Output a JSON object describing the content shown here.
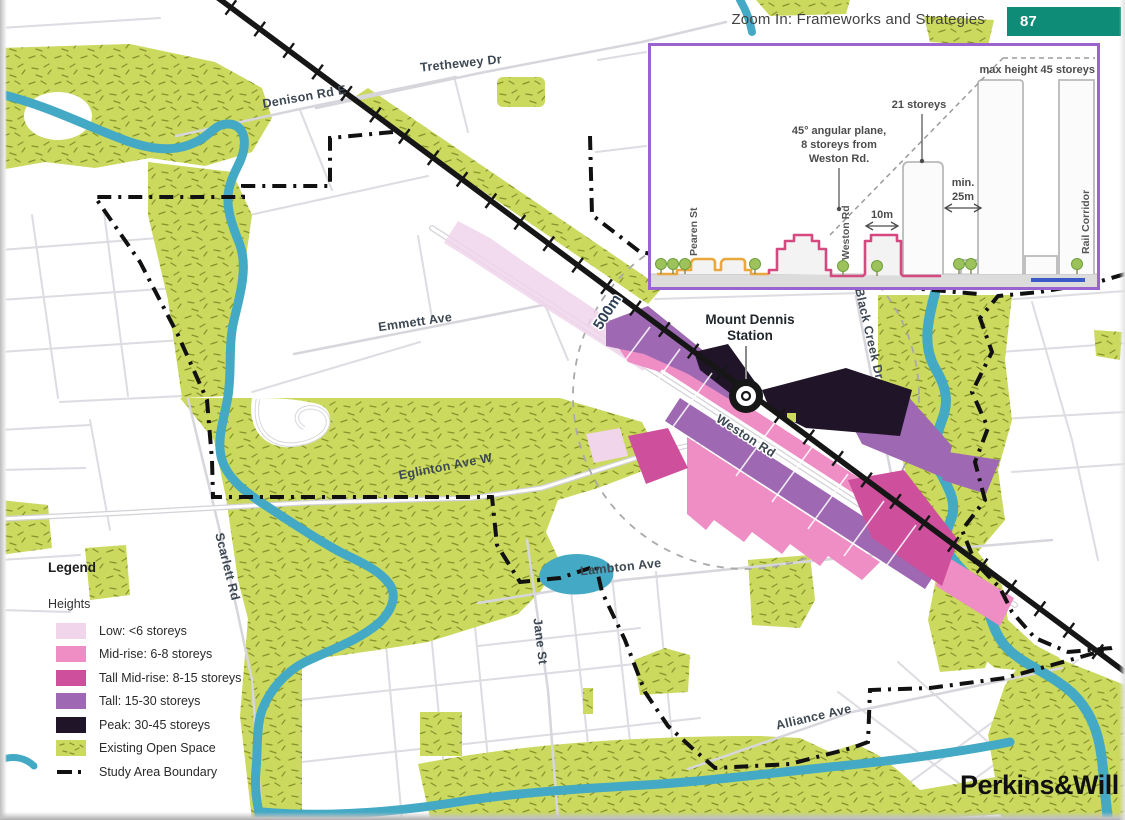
{
  "header": {
    "title": "Zoom In: Frameworks and Strategies",
    "page_number": "87",
    "page_number_bg": "#0E8C78"
  },
  "inset": {
    "border_color": "#9A63CF",
    "annotations": {
      "max_height": "max height 45 storeys",
      "storeys_21": "21 storeys",
      "plane_line1": "45° angular plane,",
      "plane_line2": "8 storeys from",
      "plane_line3": "Weston Rd.",
      "min_line1": "min.",
      "min_line2": "25m",
      "dim_10m": "10m"
    },
    "streets": {
      "pearen": "Pearen St",
      "weston": "Weston Rd",
      "rail_corridor": "Rail Corridor"
    },
    "colors": {
      "low_outline": "#EAA73E",
      "midrise_outline": "#D6487F",
      "tower_outline": "#B9B9B9",
      "rail_line": "#3B5AC7"
    }
  },
  "map": {
    "labels": {
      "trethewey": "Trethewey Dr",
      "denison": "Denison Rd E",
      "emmett": "Emmett Ave",
      "eglinton": "Eglinton Ave W",
      "weston": "Weston Rd",
      "lambton": "Lambton Ave",
      "jane": "Jane St",
      "alliance": "Alliance Ave",
      "scarlett": "Scarlett Rd",
      "black_creek": "Black Creek Dr",
      "scale": "500m",
      "station_line1": "Mount Dennis",
      "station_line2": "Station"
    },
    "colors": {
      "river": "#43A9C4",
      "street": "#DCDCE2"
    }
  },
  "legend": {
    "title": "Legend",
    "subtitle": "Heights",
    "items": [
      {
        "label": "Low: <6 storeys",
        "color": "#F0D5EB"
      },
      {
        "label": "Mid-rise: 6-8 storeys",
        "color": "#EF8DC5"
      },
      {
        "label": "Tall Mid-rise: 8-15 storeys",
        "color": "#CE4F9B"
      },
      {
        "label": "Tall: 15-30 storeys",
        "color": "#9E69B2"
      },
      {
        "label": "Peak: 30-45 storeys",
        "color": "#201428"
      }
    ],
    "open_space": {
      "label": "Existing Open Space",
      "color": "#CBD95E"
    },
    "boundary": {
      "label": "Study Area Boundary"
    }
  },
  "footer": {
    "logo": "Perkins&Will"
  }
}
